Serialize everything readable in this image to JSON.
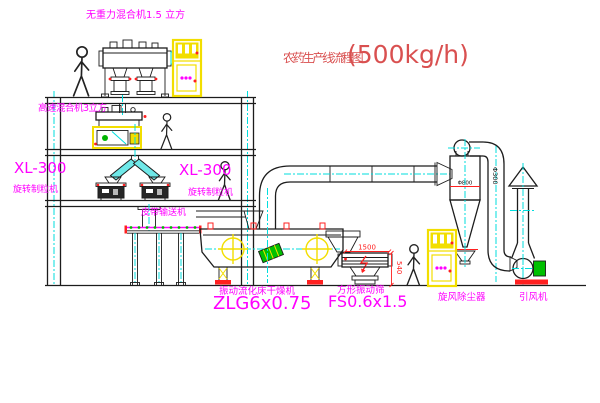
{
  "diagram": {
    "title": {
      "text": "农药生产线流程图",
      "capacity": "(500kg/h)"
    },
    "labels": {
      "gravity_mixer": "无重力混合机1.5 立方",
      "high_speed_mixer": "高速混合机3立方",
      "granulator_left_model": "XL-300",
      "granulator_left_name": "旋转制粒机",
      "granulator_right_model": "XL-300",
      "granulator_right_name": "旋转制粒机",
      "belt_conveyor": "皮带输送机",
      "dryer_name": "振动流化床干燥机",
      "dryer_model": "ZLG6x0.75",
      "screener_name": "方形振动筛",
      "screener_model": "FS0.6x1.5",
      "cyclone_name": "旋风除尘器",
      "fan_name": "引风机"
    },
    "dimensions": {
      "screener_length": "1500",
      "screener_height": "540",
      "pipe_diameter": "Φ300",
      "cyclone_diameter": "Φ800"
    },
    "colors": {
      "label_magenta": "#ff00ff",
      "title_red": "#d95050",
      "line_black": "#1c1c1c",
      "centerline_cyan": "#00dede",
      "equipment_yellow": "#f2de00",
      "accent_red": "#ff2020",
      "accent_green": "#00b400",
      "background": "#ffffff"
    }
  }
}
